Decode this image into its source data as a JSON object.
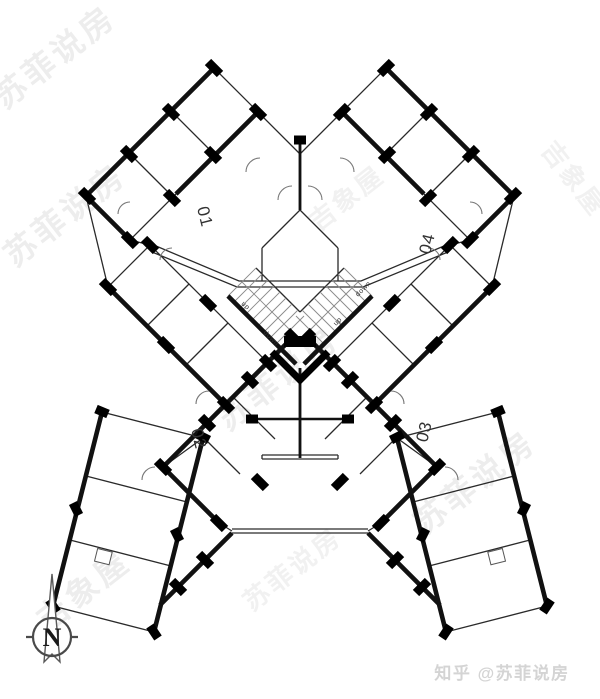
{
  "plan": {
    "unit_labels": {
      "u01": "01",
      "u02": "02",
      "u03": "03",
      "u04": "04"
    },
    "stair_labels": {
      "left_top": "up",
      "left_bottom": "down",
      "right_top": "down",
      "right_bottom": "up"
    },
    "compass_label": "N"
  },
  "watermarks": {
    "brand": "苏菲说房",
    "brand_alt": "吉象屋"
  },
  "attribution": {
    "text": "知乎 @苏菲说房"
  },
  "colors": {
    "wall": "#111111",
    "thin_line": "#2a2a2a",
    "door_arc": "#777777",
    "watermark": "#c9c9c9",
    "attribution_text": "#d4d4d4",
    "background": "#ffffff"
  }
}
